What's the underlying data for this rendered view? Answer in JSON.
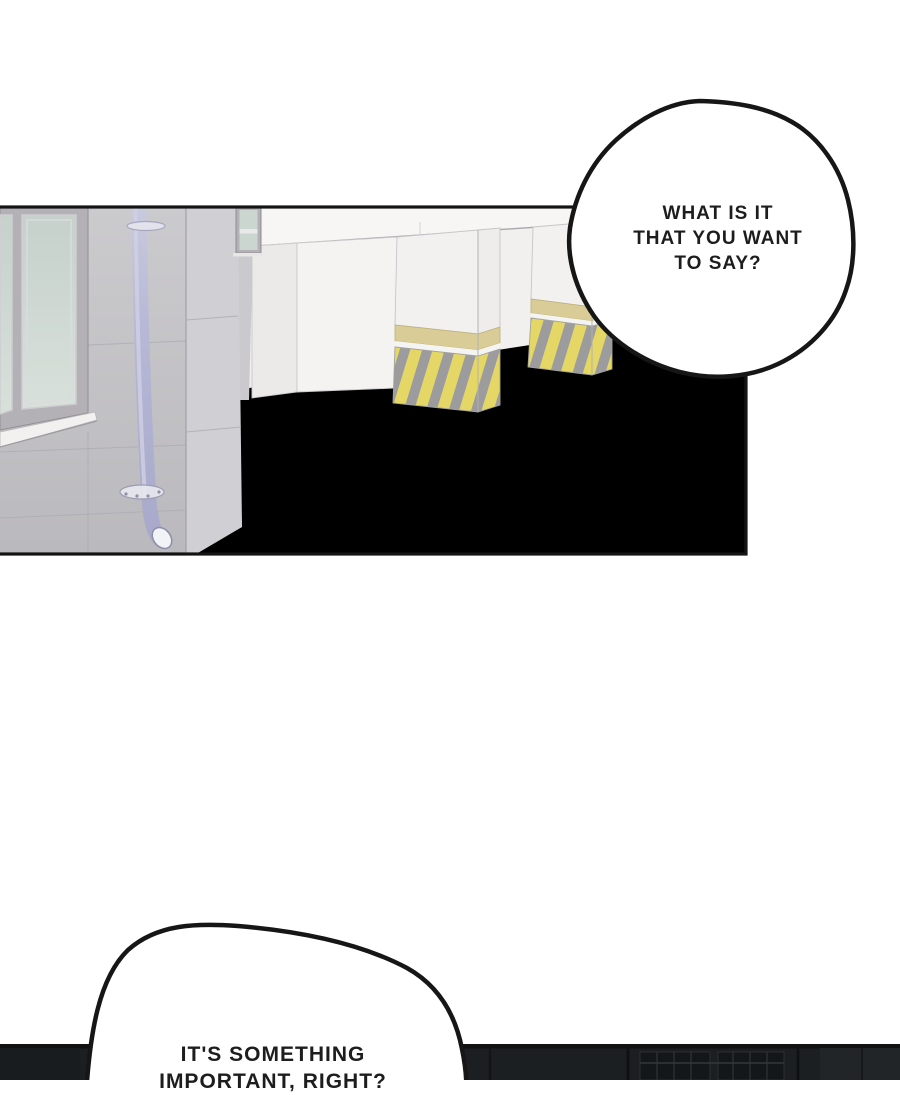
{
  "page": {
    "type": "webtoon comic page",
    "background": "#ffffff"
  },
  "bubbles": {
    "top": {
      "lines": [
        "WHAT IS IT",
        "THAT YOU WANT",
        "TO SAY?"
      ]
    },
    "bottom": {
      "lines": [
        "IT'S SOMETHING",
        "IMPORTANT, RIGHT?"
      ]
    }
  },
  "colors": {
    "panel_border": "#141414",
    "bubble_outline": "#161616",
    "bubble_fill": "#ffffff",
    "ceiling_white": "#f7f6f4",
    "far_wall_white": "#f1f0ee",
    "pillar_white": "#f4f3f1",
    "pillar_side": "#eeedeb",
    "gray_wall_side": "#d0cfd3",
    "corner_strip": "#cac9cd",
    "floor_beige": "#dfdaca",
    "hazard_yellow": "#e4d766",
    "hazard_gray": "#9c9c9f",
    "band_tan": "#d9cc96",
    "window_frame": "#b3b1b5",
    "glass_green": "#ccd6d0",
    "sill_white": "#f2f1ef",
    "pipe_lavender": "#b5b6d5",
    "dark_panel": "#1c1f22"
  }
}
